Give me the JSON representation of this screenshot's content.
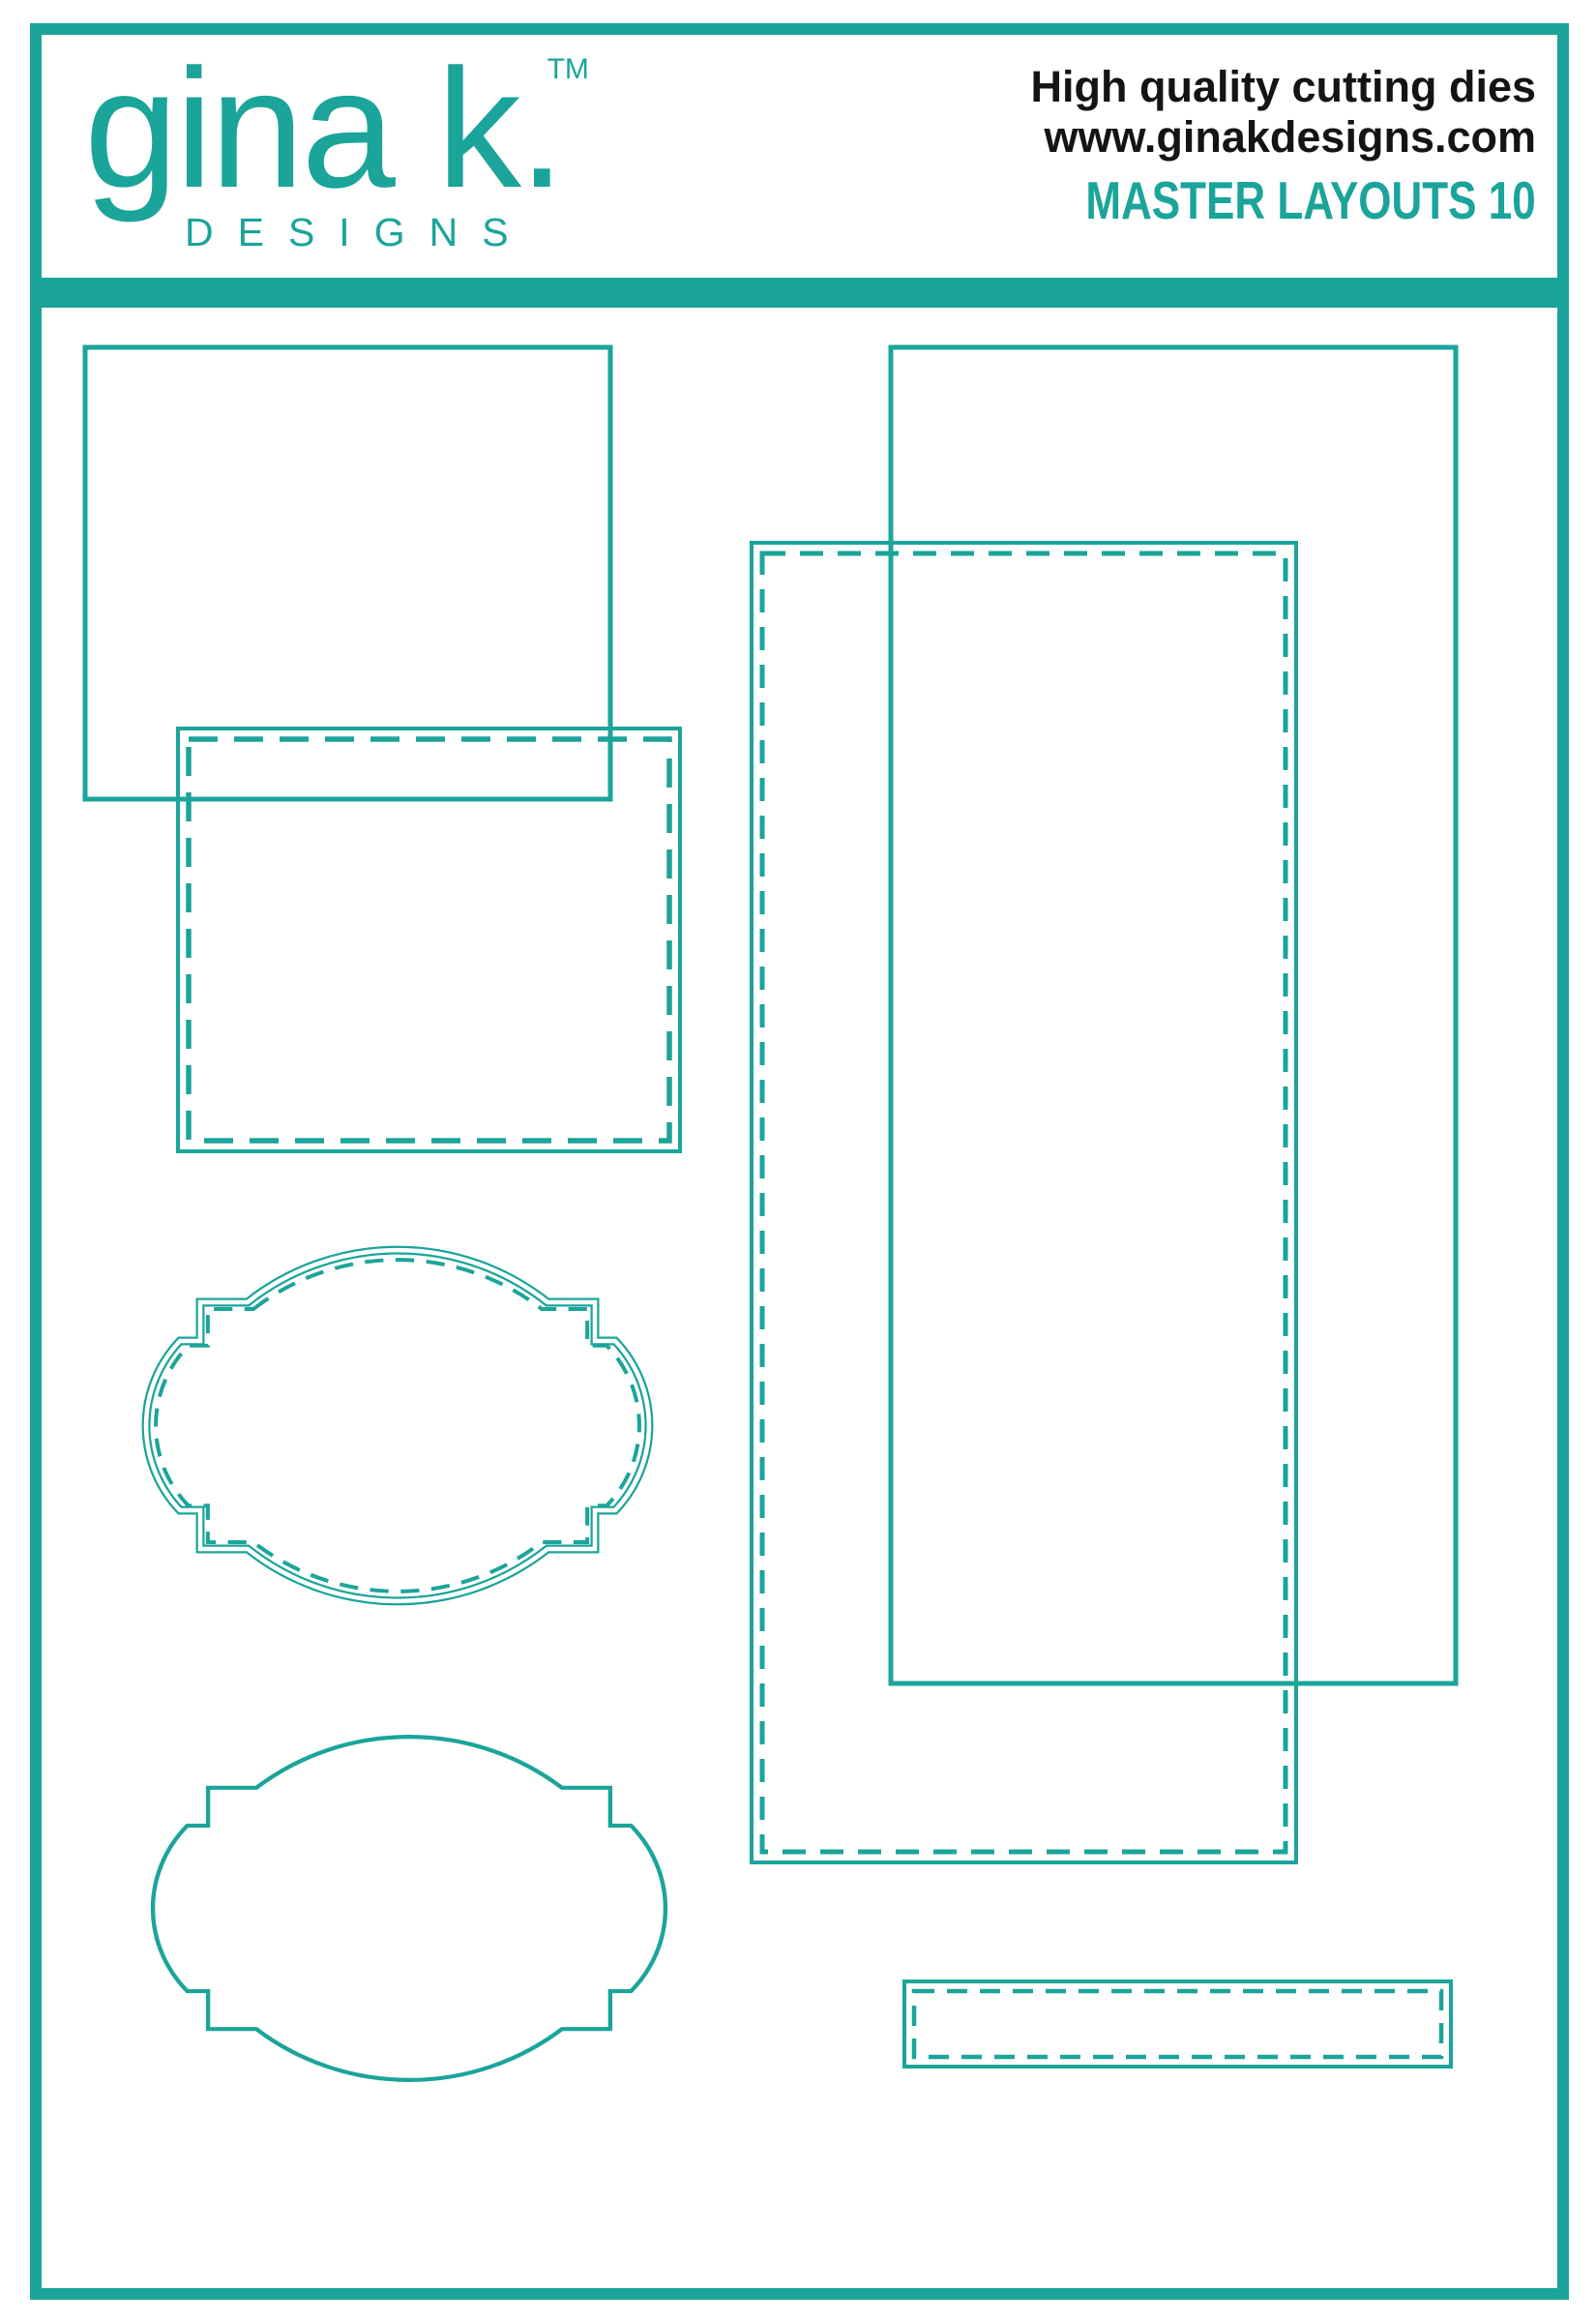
{
  "colors": {
    "accent": "#1BA49A",
    "text": "#141414",
    "background": "#FFFFFF"
  },
  "header": {
    "logo": {
      "name": "gina k.",
      "trademark": "TM",
      "subtitle": "DESIGNS"
    },
    "tagline_line1": "High quality cutting dies",
    "tagline_line2": "www.ginakdesigns.com",
    "product_name": "MASTER LAYOUTS 10"
  },
  "shapes": [
    {
      "name": "large-rectangle-die",
      "outline": "solid"
    },
    {
      "name": "stitched-rectangle-die",
      "outline": "solid-with-inner-stitch"
    },
    {
      "name": "slimline-rectangle-die",
      "outline": "solid"
    },
    {
      "name": "stitched-slimline-rectangle-die",
      "outline": "solid-with-inner-stitch"
    },
    {
      "name": "stitched-label-frame-die",
      "outline": "double-with-inner-stitch"
    },
    {
      "name": "label-frame-die",
      "outline": "solid"
    },
    {
      "name": "stitched-border-strip-die",
      "outline": "solid-with-inner-stitch"
    }
  ]
}
